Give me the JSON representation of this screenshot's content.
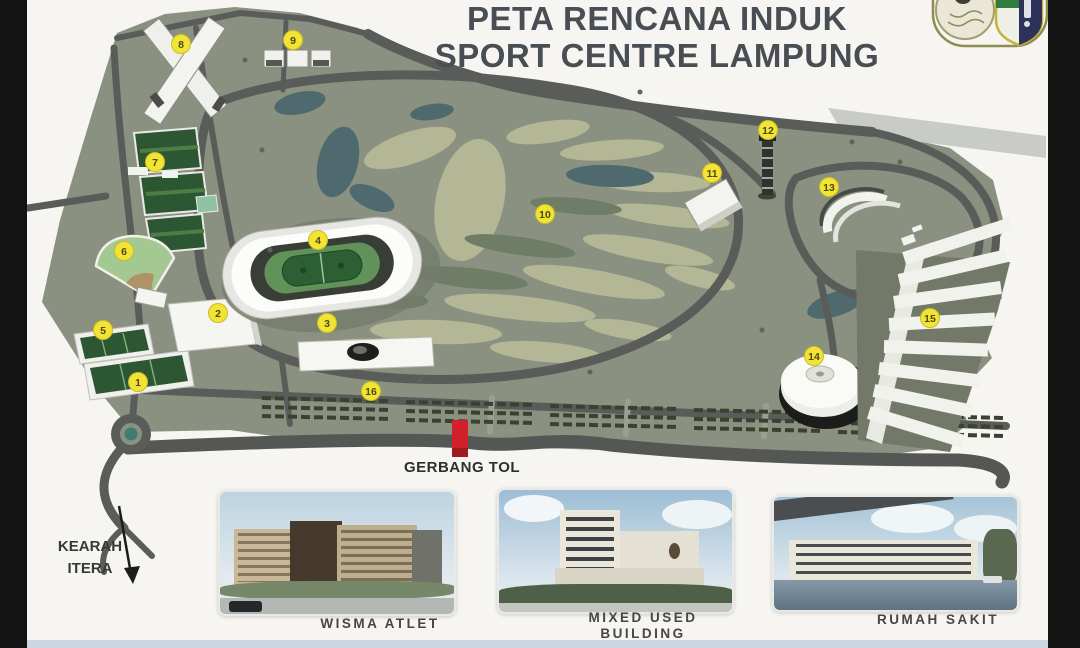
{
  "title": {
    "line1": "PETA RENCANA INDUK",
    "line2": "SPORT CENTRE LAMPUNG"
  },
  "map": {
    "markers": [
      {
        "n": "1",
        "x": 138,
        "y": 382
      },
      {
        "n": "2",
        "x": 218,
        "y": 313
      },
      {
        "n": "3",
        "x": 327,
        "y": 323
      },
      {
        "n": "4",
        "x": 318,
        "y": 240
      },
      {
        "n": "5",
        "x": 103,
        "y": 330
      },
      {
        "n": "6",
        "x": 124,
        "y": 251
      },
      {
        "n": "7",
        "x": 155,
        "y": 162
      },
      {
        "n": "8",
        "x": 181,
        "y": 44
      },
      {
        "n": "9",
        "x": 293,
        "y": 40
      },
      {
        "n": "10",
        "x": 545,
        "y": 214
      },
      {
        "n": "11",
        "x": 712,
        "y": 173
      },
      {
        "n": "12",
        "x": 768,
        "y": 130
      },
      {
        "n": "13",
        "x": 829,
        "y": 187
      },
      {
        "n": "14",
        "x": 814,
        "y": 356
      },
      {
        "n": "15",
        "x": 930,
        "y": 318
      },
      {
        "n": "16",
        "x": 371,
        "y": 391
      }
    ],
    "labels": {
      "gerbang_tol": "GERBANG TOL",
      "kearah_line1": "KEARAH",
      "kearah_line2": "ITERA"
    }
  },
  "gallery": [
    {
      "caption_line1": "WISMA ATLET",
      "caption_line2": ""
    },
    {
      "caption_line1": "MIXED USED",
      "caption_line2": "BUILDING"
    },
    {
      "caption_line1": "RUMAH SAKIT",
      "caption_line2": ""
    }
  ],
  "colors": {
    "land": "#8b9181",
    "golf_sand": "#b4b795",
    "water": "#4f6a6e",
    "road": "#5a5c5a",
    "marker_yellow": "#f2e335",
    "toll_gate_red": "#d1202a",
    "title_text": "#494e54",
    "letterbox": "#131313"
  }
}
